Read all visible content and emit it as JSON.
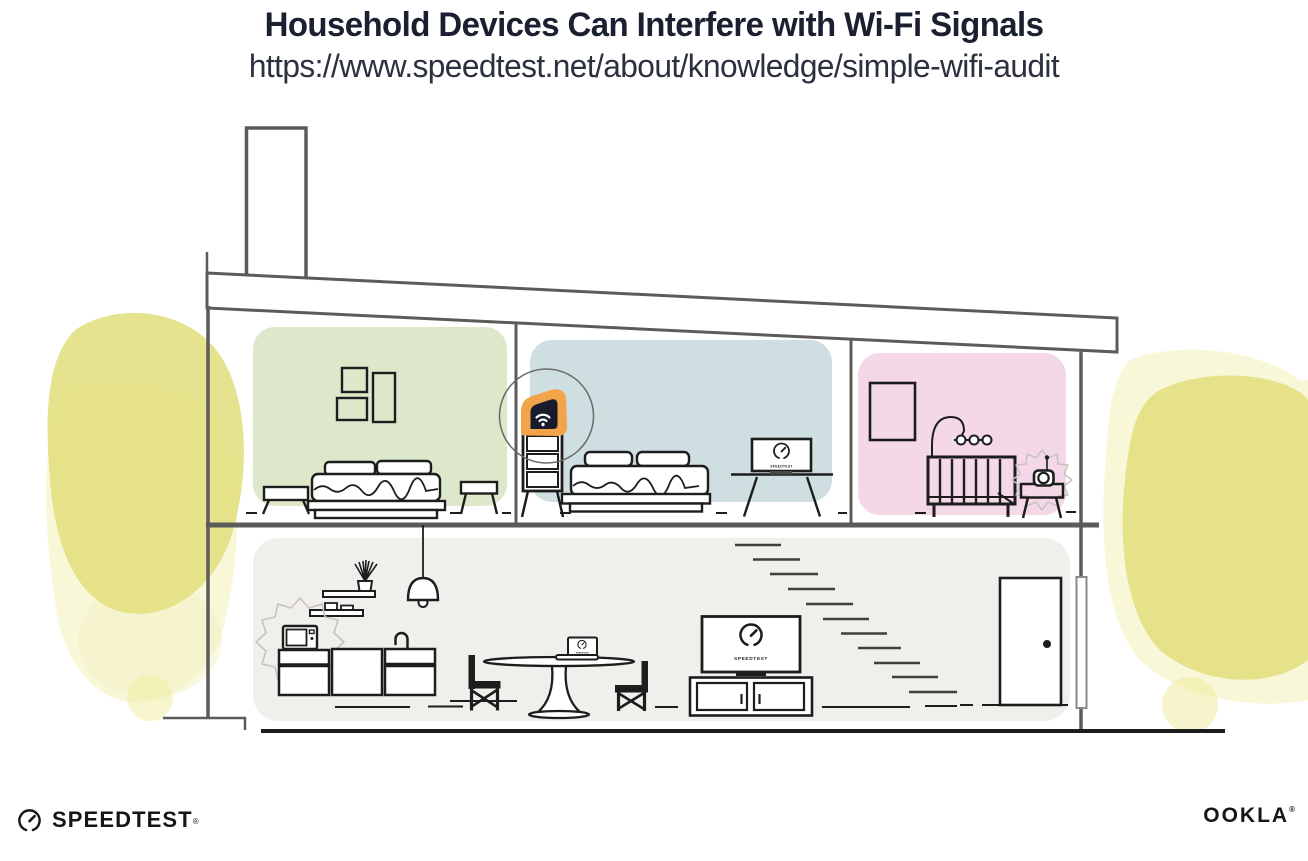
{
  "header": {
    "title": "Household Devices Can Interfere with Wi-Fi Signals",
    "url": "https://www.speedtest.net/about/knowledge/simple-wifi-audit"
  },
  "screens": {
    "tv_label": "SPEEDTEST",
    "monitor_label": "SPEEDTEST",
    "laptop_label": "SPEEDTEST"
  },
  "footer": {
    "speedtest_wordmark": "SPEEDTEST",
    "ookla_wordmark": "OOKLA",
    "registered_mark": "®"
  },
  "colors": {
    "title_ink": "#1b2031",
    "structure_line": "#5c5b59",
    "furniture_ink": "#1d1d1d",
    "room_green": "#dde8ca",
    "room_blue": "#cedee1",
    "room_pink": "#f5d8e8",
    "lower_floor_gray": "#f1efec",
    "router_orange": "#f2a44b",
    "brand_navy": "#171b2d",
    "foliage_core": "#e2de7b",
    "foliage_wash": "#f4f2c3"
  },
  "icons": {
    "router": "wifi-router-icon",
    "speed_gauge": "speedtest-gauge-icon",
    "interference": "interference-burst-outline"
  }
}
